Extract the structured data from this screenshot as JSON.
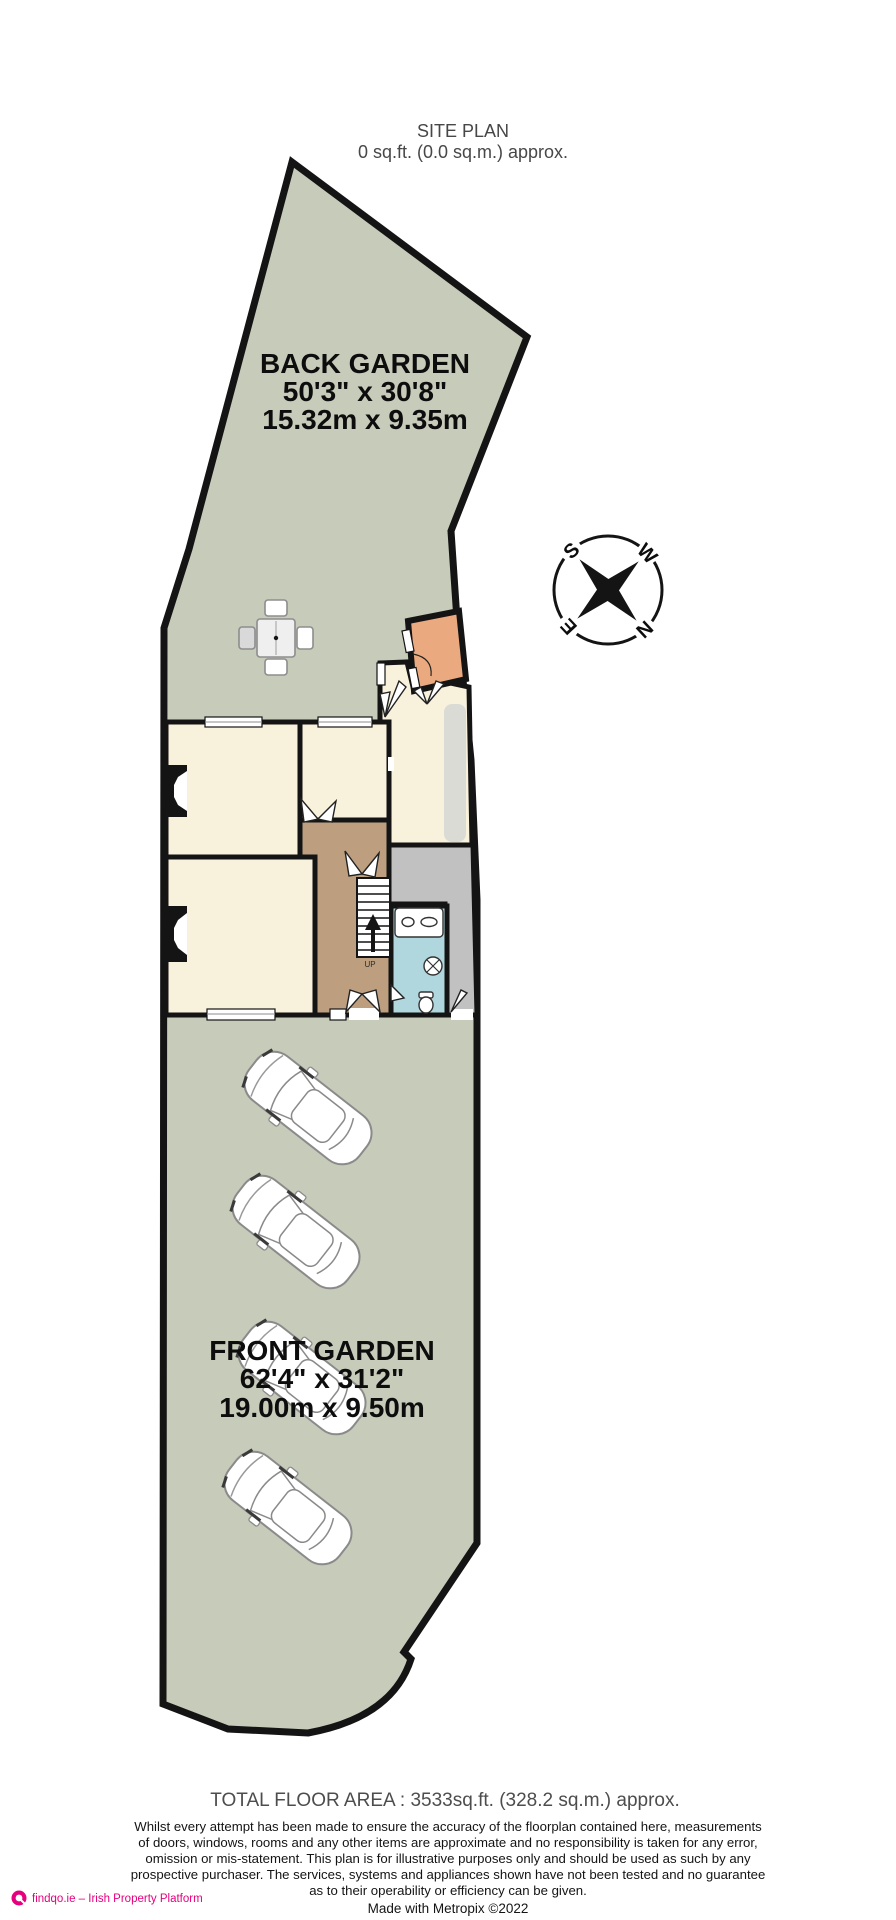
{
  "title": {
    "name": "SITE PLAN",
    "area": "0 sq.ft. (0.0 sq.m.) approx."
  },
  "back_garden": {
    "name": "BACK GARDEN",
    "size_imperial": "50'3\"  x 30'8\"",
    "size_metric": "15.32m  x 9.35m"
  },
  "front_garden": {
    "name": "FRONT GARDEN",
    "size_imperial": "62'4\"  x 31'2\"",
    "size_metric": "19.00m  x 9.50m"
  },
  "compass": {
    "north": "N",
    "south": "S",
    "east": "E",
    "west": "W"
  },
  "stairs": {
    "label": "UP"
  },
  "footer": {
    "total_area": "TOTAL FLOOR AREA : 3533sq.ft. (328.2 sq.m.) approx.",
    "disclaimer_lines": [
      "Whilst every attempt has been made to ensure the accuracy of the floorplan contained here, measurements",
      "of doors, windows, rooms and any other items are approximate and no responsibility is taken for any error,",
      "omission or mis-statement. This plan is for illustrative purposes only and should be used as such by any",
      "prospective purchaser. The services, systems and appliances shown have not been tested and no guarantee",
      "as to their operability or efficiency can be given."
    ],
    "credit": "Made with Metropix ©2022"
  },
  "branding": {
    "text": "findqo.ie – Irish Property Platform"
  },
  "colors": {
    "garden": "#C6CBBA",
    "room": "#F8F1DC",
    "hallway": "#BD9F80",
    "bathroom": "#AFD7DD",
    "utility": "#C1C1C1",
    "porch": "#EAA97E",
    "wall": "#141414",
    "brand": "#E6007E"
  }
}
